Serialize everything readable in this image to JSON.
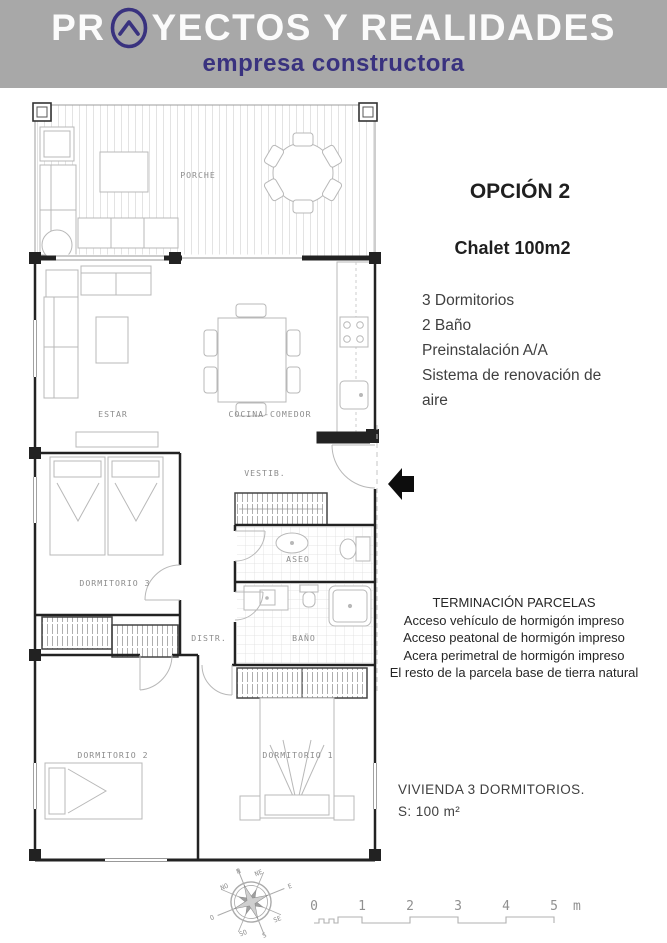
{
  "header": {
    "brand_prefix": "PR",
    "brand_suffix": "YECTOS Y REALIDADES",
    "subtitle": "empresa constructora",
    "brand_color": "#39327f",
    "band_color": "#a8a8a8"
  },
  "offer": {
    "title": "OPCIÓN 2",
    "model": "Chalet 100m2",
    "features": [
      "3 Dormitorios",
      "2 Baño",
      "Preinstalación A/A",
      "Sistema de renovación de aire"
    ]
  },
  "finishes": {
    "title": "TERMINACIÓN PARCELAS",
    "lines": [
      "Acceso vehículo  de hormigón impreso",
      "Acceso peatonal de hormigón impreso",
      "Acera perimetral de hormigón impreso",
      "El resto de la parcela base de tierra natural"
    ]
  },
  "summary": {
    "type_line": "VIVIENDA 3 DORMITORIOS.",
    "surface_line": "S: 100 m²"
  },
  "floorplan": {
    "rooms": {
      "porch": "PORCHE",
      "living": "ESTAR",
      "kitchen": "COCINA-COMEDOR",
      "hall": "VESTIB.",
      "bedroom3": "DORMITORIO 3",
      "toilet": "ASEO",
      "corridor": "DISTR.",
      "bathroom": "BAÑO",
      "bedroom2": "DORMITORIO 2",
      "bedroom1": "DORMITORIO 1"
    }
  },
  "compass": {
    "points": [
      "N",
      "NE",
      "E",
      "SE",
      "S",
      "SO",
      "O",
      "NO"
    ]
  },
  "scale_bar": {
    "ticks": [
      "0",
      "1",
      "2",
      "3",
      "4",
      "5"
    ],
    "unit": "m"
  }
}
